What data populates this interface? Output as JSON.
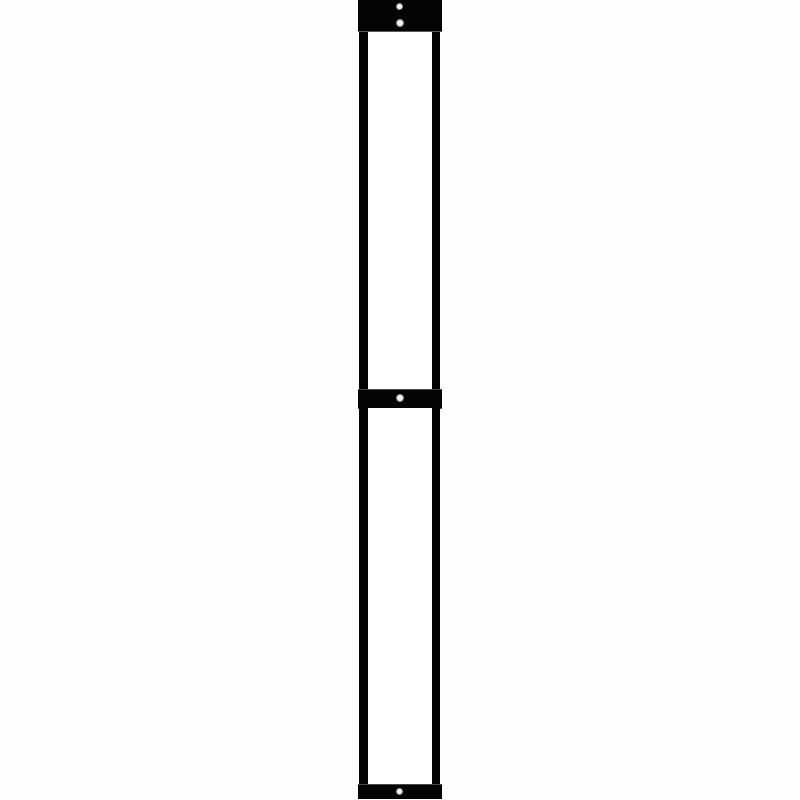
{
  "scene": {
    "background_color": "#fdfdfc",
    "frame_color": "#040404",
    "panel_color": "#ffffff",
    "screw_color": "#f2f2f2",
    "text": ""
  },
  "structure": {
    "bands": [
      {
        "name": "top-mounting-band",
        "screws": 2
      },
      {
        "name": "middle-mounting-band",
        "screws": 1
      },
      {
        "name": "bottom-mounting-band",
        "screws": 1
      }
    ],
    "panels": 2,
    "rails": 4,
    "screw_icon": "phillips-screw-head"
  }
}
